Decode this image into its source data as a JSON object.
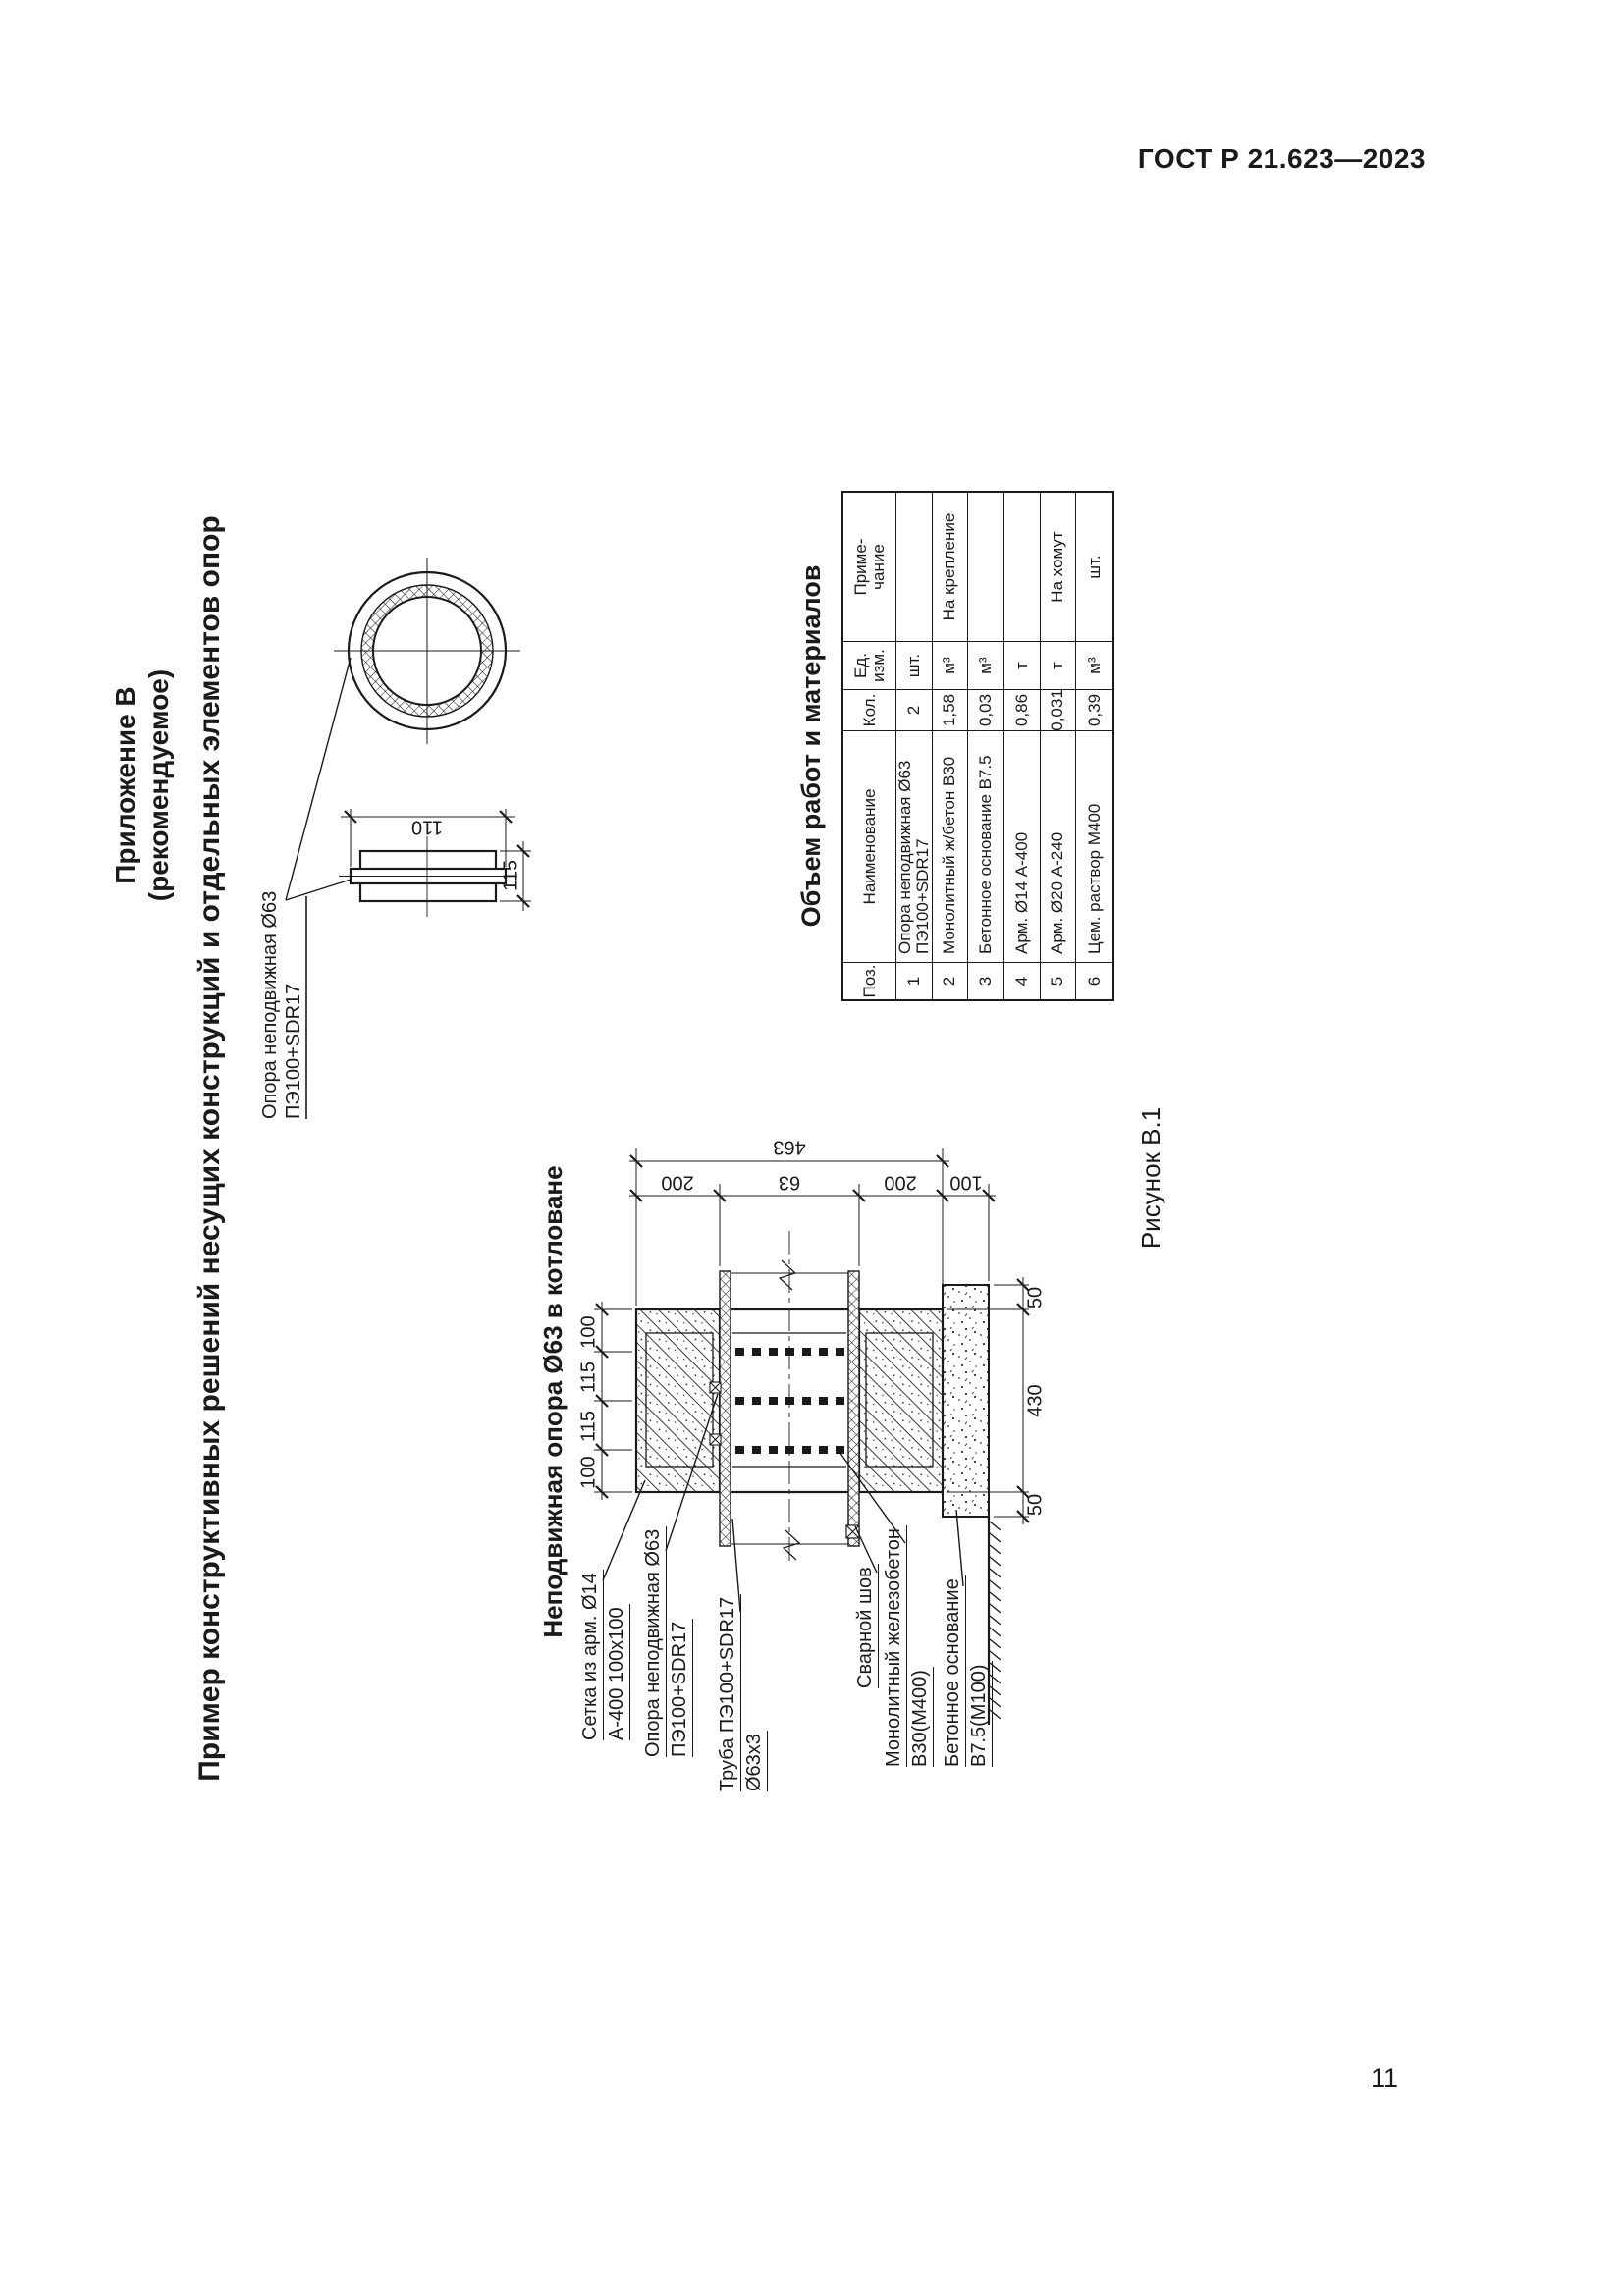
{
  "page": {
    "standard": "ГОСТ Р 21.623—2023",
    "number": "11"
  },
  "appendix": {
    "title": "Приложение В",
    "subtitle": "(рекомендуемое)"
  },
  "main_title": "Пример конструктивных решений несущих конструкций и отдельных элементов опор",
  "detail": {
    "label_line1": "Опора неподвижная Ø63",
    "label_line2": "ПЭ100+SDR17",
    "dim_length": "110",
    "dim_height": "115"
  },
  "support_drawing": {
    "title": "Неподвижная опора Ø63 в котловане",
    "dims": {
      "total": "463",
      "seg1": "200",
      "seg2": "63",
      "seg3": "200",
      "seg4": "100",
      "w1": "100",
      "w2": "115",
      "w3": "115",
      "w4": "100",
      "b1": "50",
      "b2": "430",
      "b3": "50"
    },
    "callouts": {
      "mesh1": "Сетка из арм. Ø14",
      "mesh2": "А-400 100x100",
      "support1": "Опора неподвижная Ø63",
      "support2": "ПЭ100+SDR17",
      "pipe1": "Труба ПЭ100+SDR17",
      "pipe2": "Ø63x3",
      "weld": "Сварной шов",
      "concrete1": "Монолитный железобетон",
      "concrete2": "В30(М400)",
      "base1": "Бетонное основание",
      "base2": "В7.5(М100)"
    }
  },
  "materials_table": {
    "title": "Объем работ и материалов",
    "headers": {
      "pos": "Поз.",
      "name": "Наименование",
      "qty": "Кол.",
      "unit": "Ед.\nизм.",
      "note": "Приме-\nчание"
    },
    "rows": [
      {
        "pos": "1",
        "name": "Опора неподвижная Ø63\nПЭ100+SDR17",
        "qty": "2",
        "unit": "шт.",
        "note": ""
      },
      {
        "pos": "2",
        "name": "Монолитный ж/бетон В30",
        "qty": "1,58",
        "unit": "м³",
        "note": "На крепление"
      },
      {
        "pos": "3",
        "name": "Бетонное основание В7.5",
        "qty": "0,03",
        "unit": "м³",
        "note": ""
      },
      {
        "pos": "4",
        "name": "Арм. Ø14 А-400",
        "qty": "0,86",
        "unit": "т",
        "note": ""
      },
      {
        "pos": "5",
        "name": "Арм. Ø20 А-240",
        "qty": "0,031",
        "unit": "т",
        "note": "На хомут"
      },
      {
        "pos": "6",
        "name": "Цем. раствор М400",
        "qty": "0,39",
        "unit": "м³",
        "note": "шт."
      }
    ]
  },
  "figure_caption": "Рисунок В.1",
  "colors": {
    "ink": "#1a1a1a",
    "paper": "#ffffff"
  }
}
